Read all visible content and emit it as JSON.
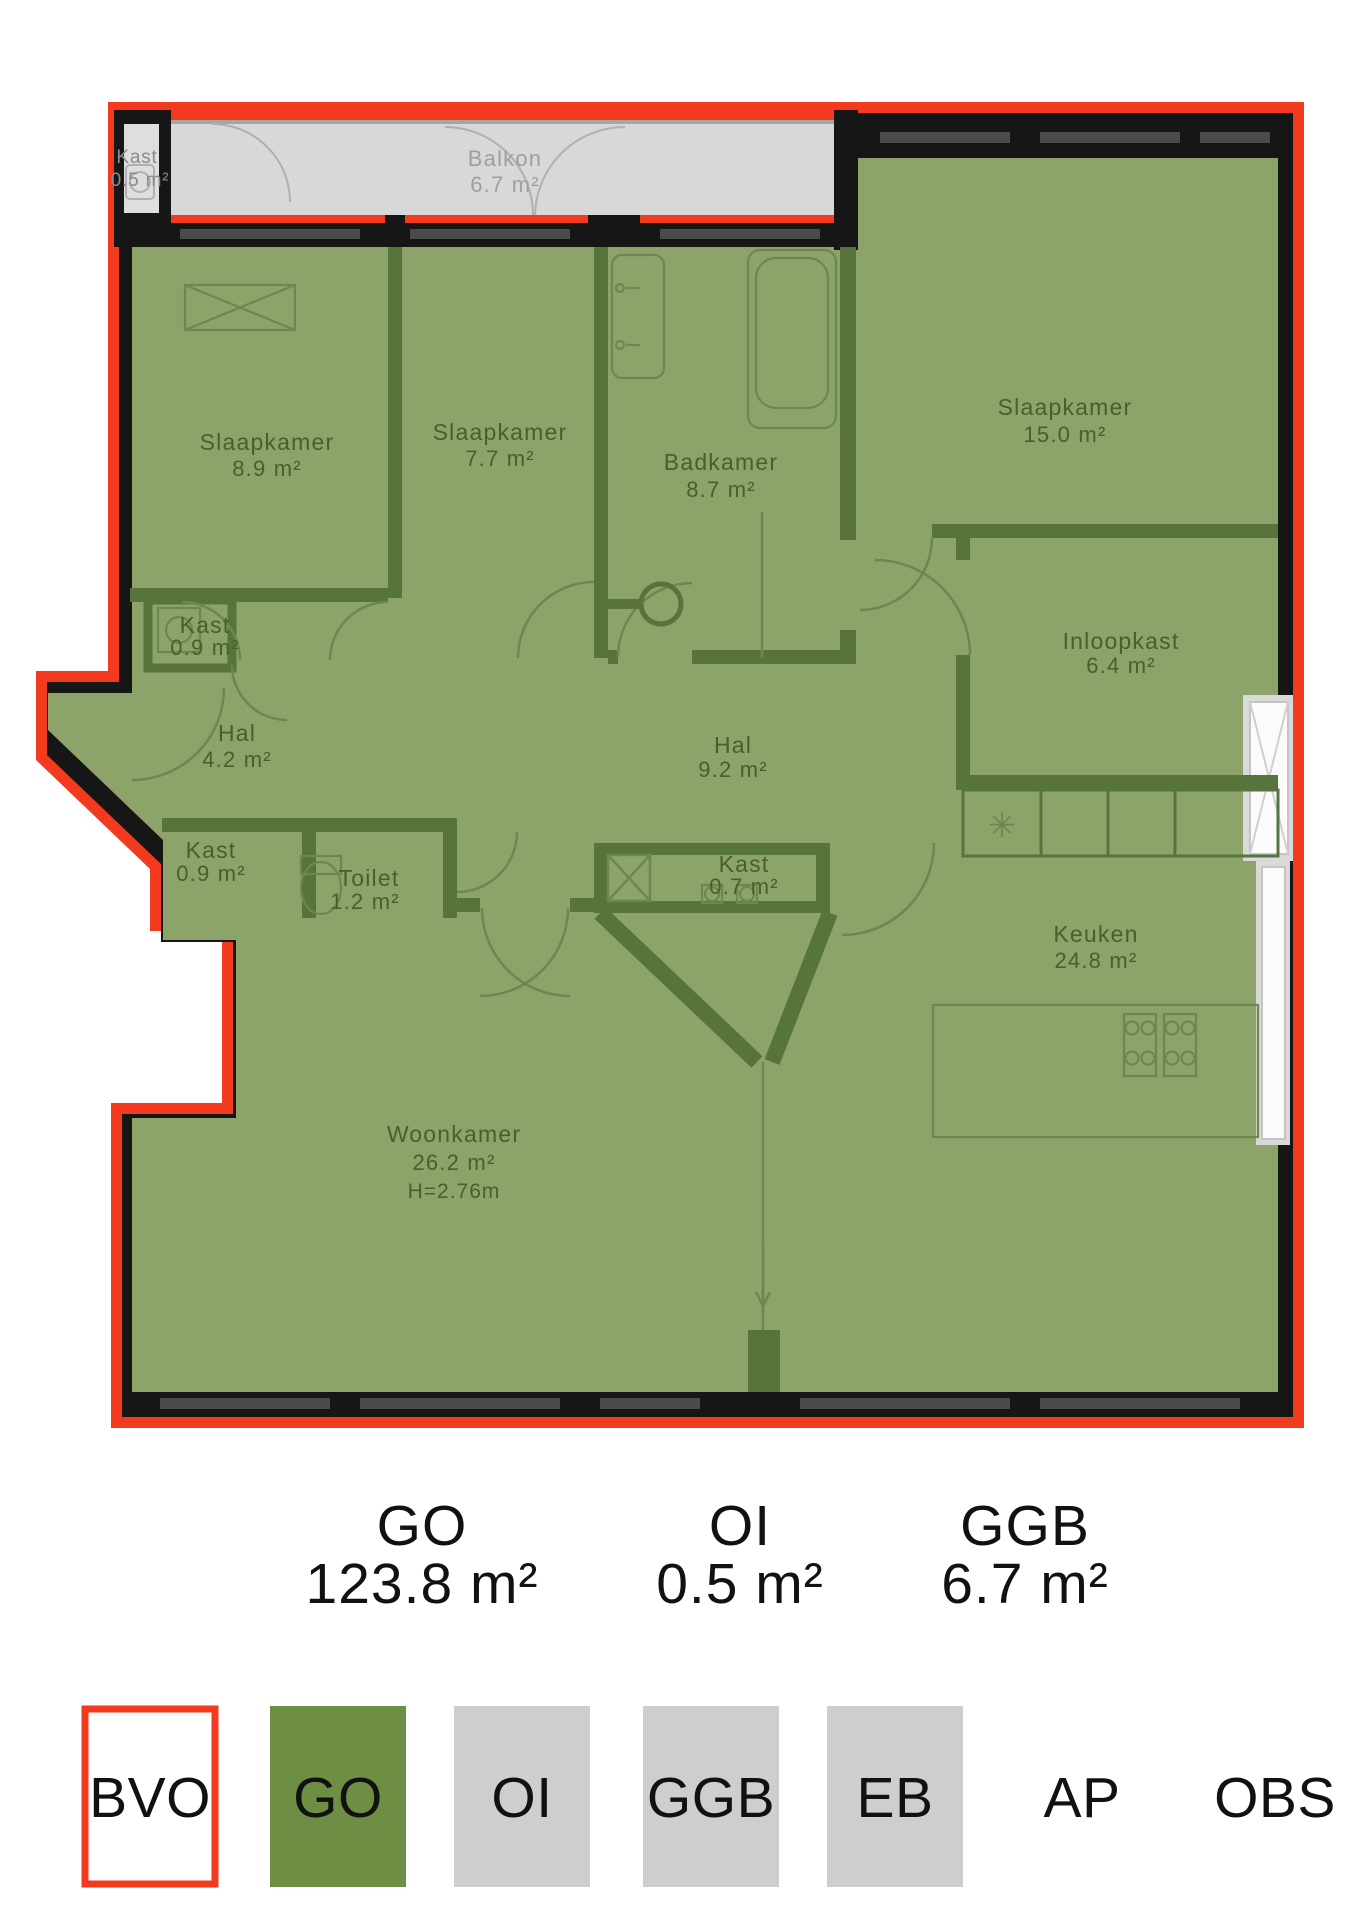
{
  "plan": {
    "rooms": [
      {
        "id": "kast-05",
        "name": "Kast",
        "area": "0.5 m²"
      },
      {
        "id": "balkon",
        "name": "Balkon",
        "area": "6.7 m²"
      },
      {
        "id": "slaapkamer-1",
        "name": "Slaapkamer",
        "area": "8.9 m²"
      },
      {
        "id": "slaapkamer-2",
        "name": "Slaapkamer",
        "area": "7.7 m²"
      },
      {
        "id": "badkamer",
        "name": "Badkamer",
        "area": "8.7 m²"
      },
      {
        "id": "slaapkamer-3",
        "name": "Slaapkamer",
        "area": "15.0 m²"
      },
      {
        "id": "kast-09-boven",
        "name": "Kast",
        "area": "0.9 m²"
      },
      {
        "id": "hal-klein",
        "name": "Hal",
        "area": "4.2 m²"
      },
      {
        "id": "kast-09-onder",
        "name": "Kast",
        "area": "0.9 m²"
      },
      {
        "id": "toilet",
        "name": "Toilet",
        "area": "1.2 m²"
      },
      {
        "id": "hal-groot",
        "name": "Hal",
        "area": "9.2 m²"
      },
      {
        "id": "kast-07",
        "name": "Kast",
        "area": "0.7 m²"
      },
      {
        "id": "inloopkast",
        "name": "Inloopkast",
        "area": "6.4 m²"
      },
      {
        "id": "keuken",
        "name": "Keuken",
        "area": "24.8 m²"
      },
      {
        "id": "woonkamer",
        "name": "Woonkamer",
        "area": "26.2 m²",
        "height": "H=2.76m"
      }
    ],
    "symbols": {
      "closet_asterisk": "✳"
    }
  },
  "summary": {
    "items": [
      {
        "code": "GO",
        "value": "123.8 m²"
      },
      {
        "code": "OI",
        "value": "0.5 m²"
      },
      {
        "code": "GGB",
        "value": "6.7 m²"
      }
    ]
  },
  "legend": {
    "items": [
      {
        "code": "BVO"
      },
      {
        "code": "GO"
      },
      {
        "code": "OI"
      },
      {
        "code": "GGB"
      },
      {
        "code": "EB"
      },
      {
        "code": "AP"
      },
      {
        "code": "OBS"
      }
    ]
  },
  "colors": {
    "bvo_outline": "#f13a1e",
    "go_fill": "#8ca46a",
    "wall_green": "#57743c",
    "go_legend": "#6e8e44",
    "grey_legend": "#cecece",
    "balcony_grey": "#d8d8d8",
    "wall_black": "#161616"
  }
}
